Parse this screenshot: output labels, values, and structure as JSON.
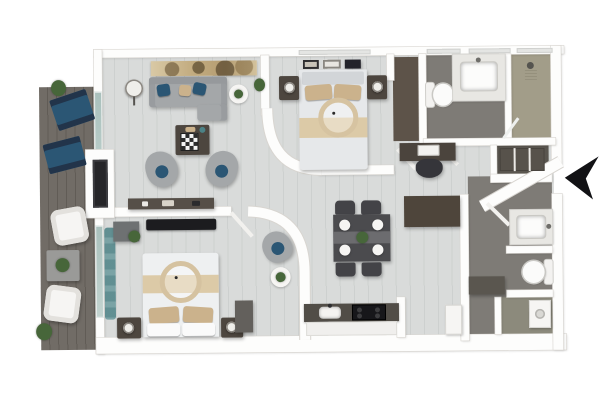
{
  "scene": {
    "type": "3d-floorplan-top-view",
    "title": "Two-bedroom two-bath apartment with balcony, 3D top-down floor plan render",
    "entry_arrow_direction": "left"
  },
  "palette": {
    "wall": "#fdfdfc",
    "wallEdge": "#d8d5d0",
    "floorLight": "#d9dbda",
    "floorSeam": "#cdd0cf",
    "deck": "#716c66",
    "deckSeam": "#615c56",
    "bathFloor": "#7e7b76",
    "showerFloor": "#a29d89",
    "laundryFloor": "#8c8a7c",
    "closetBrown": "#5d5349",
    "closetDark": "#5a564f",
    "shelfDark": "#57524b",
    "furnGray": "#a4a7a9",
    "furnDarkWood": "#4d463f",
    "counterDark": "#514d47",
    "navy": "#2b5674",
    "tan": "#cbb28c",
    "tanLight": "#dccaa7",
    "teal": "#4c8286",
    "glassTeal": "#a9c0bc",
    "green": "#47663a",
    "black": "#17171a",
    "white": "#f6f5f3",
    "windowPane": "#e4e5e3"
  },
  "rooms": {
    "balcony": {
      "label": "balcony with deck, lounge chairs and armchairs"
    },
    "living": {
      "label": "living room with sofa, swivel chairs and coffee table"
    },
    "bedroom2": {
      "label": "bedroom 2 with bed, nightstands, TV and reading chair"
    },
    "master": {
      "label": "master bedroom with bed and nightstands"
    },
    "closetMaster": {
      "label": "walk-in closet with dark carpet and desk nook"
    },
    "bath1": {
      "label": "bathroom 1 with toilet and vanity"
    },
    "shower": {
      "label": "shower room"
    },
    "closet2": {
      "label": "hall walk-in closet with shelving"
    },
    "dining": {
      "label": "dining area with table for four"
    },
    "kitchen": {
      "label": "kitchen with sink, cooktop and pantry"
    },
    "entry": {
      "label": "entry hall"
    },
    "bath2": {
      "label": "bathroom 2 with vanity and toilet"
    },
    "laundry": {
      "label": "laundry nook with washer"
    }
  },
  "furniture": {
    "balcony": [
      "potted-plant",
      "sling-chair",
      "sling-chair",
      "white-armchair",
      "patio-table-with-plant",
      "white-armchair",
      "potted-plant"
    ],
    "living": [
      "panoramic-wall-art",
      "arc-floor-lamp",
      "gray-sofa-with-navy-and-tan-pillows",
      "round-side-table-with-plant",
      "wall-plant",
      "dark-coffee-table-with-chessboard",
      "swivel-chair",
      "swivel-chair",
      "media-console",
      "wall-mounted-tv"
    ],
    "bedroom2": [
      "wall-tv",
      "teal-curtains",
      "dresser-with-plant",
      "double-bed-with-ring-canopy",
      "nightstand-with-lamp",
      "nightstand-with-lamp",
      "dresser",
      "reading-chair",
      "round-table-with-plant"
    ],
    "master": [
      "three-picture-frames",
      "double-bed-with-ring-canopy",
      "nightstand-with-lamp",
      "nightstand-with-lamp"
    ],
    "closetMaster": [
      "desk-with-laptop",
      "office-chair"
    ],
    "bath1": [
      "toilet",
      "vanity-with-sink"
    ],
    "shower": [
      "shower-head",
      "glass-door"
    ],
    "closet2": [
      "shelving-unit"
    ],
    "dining": [
      "dining-table",
      "dining-chair",
      "dining-chair",
      "dining-chair",
      "dining-chair",
      "four-plates",
      "plant-centerpiece"
    ],
    "kitchen": [
      "counter",
      "sink",
      "cooktop",
      "base-cabinets",
      "pantry-cabinet",
      "refrigerator"
    ],
    "bath2": [
      "vanity-with-sink",
      "toilet",
      "entry-door"
    ],
    "laundry": [
      "washer",
      "storage-closet"
    ]
  }
}
